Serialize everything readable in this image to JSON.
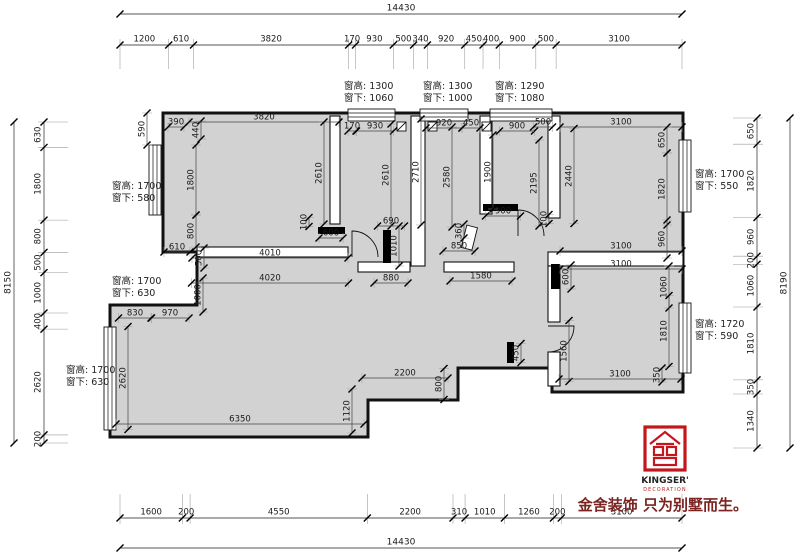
{
  "dims": {
    "top": {
      "total": "14430",
      "segments": [
        1200,
        610,
        3820,
        170,
        930,
        500,
        340,
        920,
        450,
        400,
        900,
        500,
        3100
      ]
    },
    "bottom": {
      "total": "14430",
      "segments": [
        1600,
        200,
        4550,
        2200,
        310,
        1010,
        1260,
        200,
        3100
      ]
    },
    "left": {
      "total": "8150",
      "segments": [
        630,
        1800,
        800,
        500,
        1000,
        400,
        2620,
        200
      ]
    },
    "right": {
      "total": "8190",
      "segments": [
        650,
        1820,
        960,
        200,
        1060,
        1810,
        350,
        1340
      ]
    }
  },
  "window_notes": [
    {
      "line1": "窗高: 1300",
      "line2": "窗下: 1060",
      "x": 344,
      "y": 80
    },
    {
      "line1": "窗高: 1300",
      "line2": "窗下: 1000",
      "x": 423,
      "y": 80
    },
    {
      "line1": "窗高: 1290",
      "line2": "窗下: 1080",
      "x": 495,
      "y": 80
    },
    {
      "line1": "窗高: 1700",
      "line2": "窗下: 580",
      "x": 112,
      "y": 180
    },
    {
      "line1": "窗高: 1700",
      "line2": "窗下: 630",
      "x": 112,
      "y": 275
    },
    {
      "line1": "窗高: 1700",
      "line2": "窗下: 630",
      "x": 66,
      "y": 364
    },
    {
      "line1": "窗高: 1700",
      "line2": "窗下: 550",
      "x": 695,
      "y": 168
    },
    {
      "line1": "窗高: 1720",
      "line2": "窗下: 590",
      "x": 695,
      "y": 318
    }
  ],
  "interior_dims": [
    {
      "t": "590",
      "o": "v",
      "x": 147,
      "y": 129,
      "l": 32
    },
    {
      "t": "390",
      "o": "h",
      "x": 176,
      "y": 127,
      "l": 16
    },
    {
      "t": "440",
      "o": "v",
      "x": 201,
      "y": 130,
      "l": 18
    },
    {
      "t": "3820",
      "o": "h",
      "x": 264,
      "y": 122,
      "l": 150
    },
    {
      "t": "1800",
      "o": "v",
      "x": 196,
      "y": 180,
      "l": 70
    },
    {
      "t": "800",
      "o": "v",
      "x": 196,
      "y": 231,
      "l": 32
    },
    {
      "t": "610",
      "o": "h",
      "x": 177,
      "y": 252,
      "l": 26
    },
    {
      "t": "500",
      "o": "v",
      "x": 204,
      "y": 258,
      "l": 20
    },
    {
      "t": "2610",
      "o": "v",
      "x": 324,
      "y": 173,
      "l": 102
    },
    {
      "t": "100",
      "o": "v",
      "x": 309,
      "y": 222,
      "l": 9
    },
    {
      "t": "600",
      "o": "h",
      "x": 331,
      "y": 238,
      "l": 24
    },
    {
      "t": "4010",
      "o": "h",
      "x": 270,
      "y": 258,
      "l": 156
    },
    {
      "t": "4020",
      "o": "h",
      "x": 270,
      "y": 283,
      "l": 157
    },
    {
      "t": "170",
      "o": "h",
      "x": 352,
      "y": 131,
      "l": 8
    },
    {
      "t": "930",
      "o": "h",
      "x": 375,
      "y": 131,
      "l": 37
    },
    {
      "t": "2610",
      "o": "v",
      "x": 391,
      "y": 175,
      "l": 102
    },
    {
      "t": "2710",
      "o": "v",
      "x": 421,
      "y": 172,
      "l": 106
    },
    {
      "t": "690",
      "o": "h",
      "x": 391,
      "y": 226,
      "l": 27
    },
    {
      "t": "1010",
      "o": "v",
      "x": 399,
      "y": 246,
      "l": 40
    },
    {
      "t": "880",
      "o": "h",
      "x": 391,
      "y": 283,
      "l": 34
    },
    {
      "t": "920",
      "o": "h",
      "x": 444,
      "y": 128,
      "l": 36
    },
    {
      "t": "450",
      "o": "h",
      "x": 471,
      "y": 128,
      "l": 18
    },
    {
      "t": "2580",
      "o": "v",
      "x": 452,
      "y": 177,
      "l": 100
    },
    {
      "t": "360",
      "o": "v",
      "x": 464,
      "y": 231,
      "l": 14
    },
    {
      "t": "850",
      "o": "h",
      "x": 459,
      "y": 251,
      "l": 32
    },
    {
      "t": "1580",
      "o": "h",
      "x": 481,
      "y": 281,
      "l": 62
    },
    {
      "t": "900",
      "o": "h",
      "x": 517,
      "y": 131,
      "l": 35
    },
    {
      "t": "500",
      "o": "h",
      "x": 543,
      "y": 127,
      "l": 19
    },
    {
      "t": "1900",
      "o": "v",
      "x": 493,
      "y": 172,
      "l": 74
    },
    {
      "t": "2195",
      "o": "v",
      "x": 539,
      "y": 183,
      "l": 86
    },
    {
      "t": "900",
      "o": "h",
      "x": 503,
      "y": 216,
      "l": 35
    },
    {
      "t": "100",
      "o": "v",
      "x": 549,
      "y": 219,
      "l": 9
    },
    {
      "t": "3100",
      "o": "h",
      "x": 621,
      "y": 127,
      "l": 122
    },
    {
      "t": "650",
      "o": "v",
      "x": 667,
      "y": 140,
      "l": 26
    },
    {
      "t": "2440",
      "o": "v",
      "x": 574,
      "y": 176,
      "l": 95
    },
    {
      "t": "1820",
      "o": "v",
      "x": 667,
      "y": 189,
      "l": 72
    },
    {
      "t": "960",
      "o": "v",
      "x": 667,
      "y": 239,
      "l": 38
    },
    {
      "t": "3100",
      "o": "h",
      "x": 621,
      "y": 251,
      "l": 122
    },
    {
      "t": "3100",
      "o": "h",
      "x": 621,
      "y": 269,
      "l": 122
    },
    {
      "t": "600",
      "o": "v",
      "x": 571,
      "y": 277,
      "l": 24
    },
    {
      "t": "1060",
      "o": "v",
      "x": 669,
      "y": 287,
      "l": 42
    },
    {
      "t": "1810",
      "o": "v",
      "x": 669,
      "y": 331,
      "l": 71
    },
    {
      "t": "1560",
      "o": "v",
      "x": 569,
      "y": 351,
      "l": 61
    },
    {
      "t": "3100",
      "o": "h",
      "x": 620,
      "y": 379,
      "l": 122
    },
    {
      "t": "350",
      "o": "v",
      "x": 662,
      "y": 375,
      "l": 14
    },
    {
      "t": "830",
      "o": "h",
      "x": 135,
      "y": 318,
      "l": 33
    },
    {
      "t": "970",
      "o": "h",
      "x": 170,
      "y": 318,
      "l": 38
    },
    {
      "t": "1000",
      "o": "v",
      "x": 203,
      "y": 295,
      "l": 34
    },
    {
      "t": "2620",
      "o": "v",
      "x": 128,
      "y": 378,
      "l": 103
    },
    {
      "t": "6350",
      "o": "h",
      "x": 240,
      "y": 424,
      "l": 248
    },
    {
      "t": "1120",
      "o": "v",
      "x": 352,
      "y": 411,
      "l": 44
    },
    {
      "t": "2200",
      "o": "h",
      "x": 405,
      "y": 378,
      "l": 86
    },
    {
      "t": "800",
      "o": "v",
      "x": 444,
      "y": 384,
      "l": 31
    },
    {
      "t": "450",
      "o": "v",
      "x": 521,
      "y": 353,
      "l": 19
    }
  ],
  "logo": {
    "brand": "KINGSER'",
    "sub": "DECORATION",
    "tagline": "金舍装饰 只为别墅而生。"
  },
  "colors": {
    "accent_red": "#c4161c",
    "tagline": "#7a2320",
    "floor": "#d2d2d2",
    "wall": "#111111",
    "dim_line": "#555555",
    "dim_text": "#1a1a1a"
  }
}
